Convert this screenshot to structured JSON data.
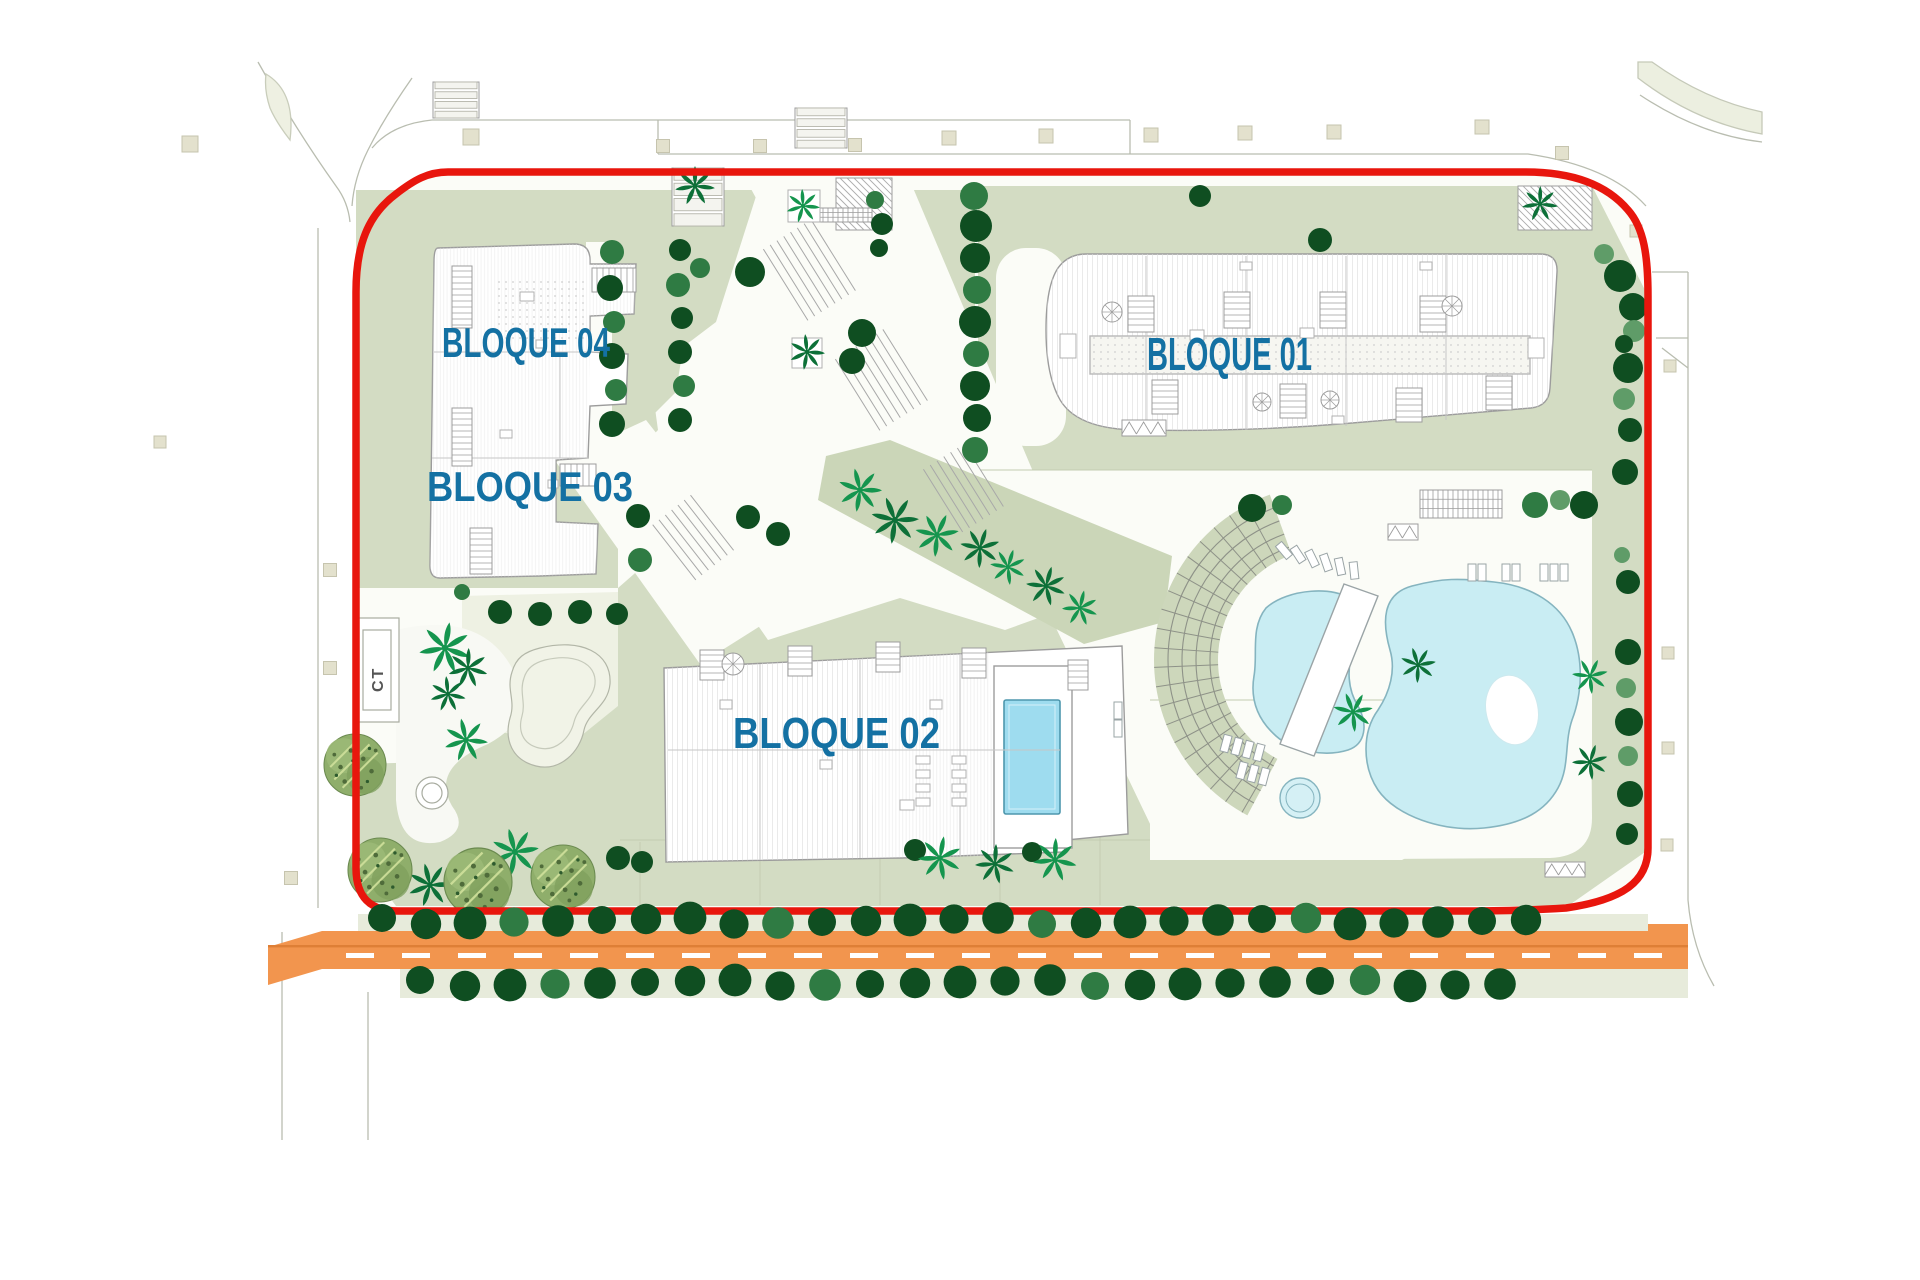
{
  "title": "Residential complex site plan",
  "labels": {
    "blocks": [
      {
        "id": "bloque-04",
        "text": "BLOQUE 04",
        "x": 442,
        "baseline": 357,
        "font": 42,
        "length": 168
      },
      {
        "id": "bloque-03",
        "text": "BLOQUE 03",
        "x": 427,
        "baseline": 501,
        "font": 42,
        "length": 206
      },
      {
        "id": "bloque-02",
        "text": "BLOQUE 02",
        "x": 733,
        "baseline": 748,
        "font": 44,
        "length": 207
      },
      {
        "id": "bloque-01",
        "text": "BLOQUE 01",
        "x": 1147,
        "baseline": 370,
        "font": 46,
        "length": 165
      }
    ],
    "ct": {
      "text": "CT"
    }
  },
  "palette": {
    "boundary_red": "#e8160d",
    "label_blue": "#1471a3",
    "sage": "#d3dcc3",
    "sage_light": "#e7ebdb",
    "cream": "#eef1e3",
    "site_white": "#fbfcf7",
    "road_orange": "#f2954e",
    "road_line": "#de7f36",
    "pool_fill": "#c9edf3",
    "pool_stroke": "#85b4bf",
    "pool_deep": "#9edcef",
    "tree_greens": [
      "#0f4e21",
      "#2f7b43",
      "#5f9c68"
    ],
    "palm_greens": [
      "#15954e",
      "#0d7038",
      "#0a5e2f"
    ],
    "outline_gray": "#9c9c9c"
  },
  "features": {
    "tree_circles": [
      [
        612,
        252,
        12,
        1
      ],
      [
        610,
        288,
        13,
        0
      ],
      [
        614,
        322,
        11,
        1
      ],
      [
        612,
        356,
        13,
        0
      ],
      [
        616,
        390,
        11,
        1
      ],
      [
        612,
        424,
        13,
        0
      ],
      [
        638,
        516,
        12,
        0
      ],
      [
        640,
        560,
        12,
        1
      ],
      [
        680,
        250,
        11,
        0
      ],
      [
        678,
        285,
        12,
        1
      ],
      [
        682,
        318,
        11,
        0
      ],
      [
        680,
        352,
        12,
        0
      ],
      [
        684,
        386,
        11,
        1
      ],
      [
        680,
        420,
        12,
        0
      ],
      [
        974,
        196,
        14,
        1
      ],
      [
        976,
        226,
        16,
        0
      ],
      [
        975,
        258,
        15,
        0
      ],
      [
        977,
        290,
        14,
        1
      ],
      [
        975,
        322,
        16,
        0
      ],
      [
        976,
        354,
        13,
        1
      ],
      [
        975,
        386,
        15,
        0
      ],
      [
        977,
        418,
        14,
        0
      ],
      [
        975,
        450,
        13,
        1
      ],
      [
        1604,
        254,
        10,
        2
      ],
      [
        1620,
        276,
        16,
        0
      ],
      [
        1633,
        307,
        14,
        0
      ],
      [
        1634,
        331,
        11,
        2
      ],
      [
        1624,
        344,
        9,
        0
      ],
      [
        1628,
        368,
        15,
        0
      ],
      [
        1624,
        399,
        11,
        2
      ],
      [
        1630,
        430,
        12,
        0
      ],
      [
        1625,
        472,
        13,
        0
      ],
      [
        1622,
        555,
        8,
        2
      ],
      [
        1628,
        582,
        12,
        0
      ],
      [
        1628,
        652,
        13,
        0
      ],
      [
        1626,
        688,
        10,
        2
      ],
      [
        1629,
        722,
        14,
        0
      ],
      [
        1628,
        756,
        10,
        2
      ],
      [
        1630,
        794,
        13,
        0
      ],
      [
        1627,
        834,
        11,
        0
      ],
      [
        750,
        272,
        15,
        0
      ],
      [
        700,
        268,
        10,
        1
      ],
      [
        862,
        333,
        14,
        0
      ],
      [
        852,
        361,
        13,
        0
      ],
      [
        748,
        517,
        12,
        0
      ],
      [
        778,
        534,
        12,
        0
      ],
      [
        875,
        200,
        9,
        1
      ],
      [
        882,
        224,
        11,
        0
      ],
      [
        879,
        248,
        9,
        0
      ],
      [
        1252,
        508,
        14,
        0
      ],
      [
        1282,
        505,
        10,
        1
      ],
      [
        1535,
        505,
        13,
        1
      ],
      [
        1560,
        500,
        10,
        2
      ],
      [
        1584,
        505,
        14,
        0
      ],
      [
        1200,
        196,
        11,
        0
      ],
      [
        1320,
        240,
        12,
        0
      ],
      [
        618,
        858,
        12,
        0
      ],
      [
        642,
        862,
        11,
        0
      ],
      [
        915,
        850,
        11,
        0
      ],
      [
        1032,
        852,
        10,
        0
      ],
      [
        500,
        612,
        12,
        0
      ],
      [
        540,
        614,
        12,
        0
      ],
      [
        580,
        612,
        12,
        0
      ],
      [
        617,
        614,
        11,
        0
      ],
      [
        462,
        592,
        8,
        1
      ]
    ],
    "road_tree_rows": [
      {
        "y": 921,
        "x0": 382,
        "step": 44,
        "n": 27
      },
      {
        "y": 983,
        "x0": 420,
        "step": 45,
        "n": 25
      }
    ],
    "palms": [
      [
        695,
        186,
        20,
        1
      ],
      [
        803,
        206,
        17,
        0
      ],
      [
        807,
        352,
        18,
        1
      ],
      [
        860,
        490,
        22,
        0
      ],
      [
        895,
        520,
        24,
        1
      ],
      [
        937,
        535,
        22,
        0
      ],
      [
        980,
        548,
        20,
        1
      ],
      [
        1008,
        567,
        18,
        0
      ],
      [
        1046,
        586,
        20,
        1
      ],
      [
        1080,
        608,
        18,
        0
      ],
      [
        445,
        648,
        26,
        0
      ],
      [
        468,
        668,
        20,
        1
      ],
      [
        448,
        694,
        18,
        1
      ],
      [
        466,
        740,
        22,
        0
      ],
      [
        430,
        885,
        22,
        1
      ],
      [
        515,
        852,
        24,
        0
      ],
      [
        1418,
        665,
        18,
        1
      ],
      [
        1353,
        712,
        20,
        0
      ],
      [
        1590,
        676,
        18,
        0
      ],
      [
        1590,
        762,
        18,
        1
      ],
      [
        940,
        858,
        22,
        0
      ],
      [
        995,
        864,
        20,
        1
      ],
      [
        1055,
        860,
        22,
        0
      ],
      [
        1540,
        204,
        18,
        1
      ]
    ],
    "olive_trees": [
      [
        355,
        765,
        31
      ],
      [
        380,
        870,
        32
      ],
      [
        478,
        882,
        34
      ],
      [
        563,
        877,
        32
      ]
    ],
    "beige_squares": [
      [
        190,
        144,
        16
      ],
      [
        471,
        137,
        16
      ],
      [
        663,
        146,
        13
      ],
      [
        760,
        146,
        13
      ],
      [
        855,
        145,
        13
      ],
      [
        949,
        138,
        14
      ],
      [
        1046,
        136,
        14
      ],
      [
        1151,
        135,
        14
      ],
      [
        1245,
        133,
        14
      ],
      [
        1334,
        132,
        14
      ],
      [
        1482,
        127,
        14
      ],
      [
        1562,
        153,
        13
      ],
      [
        1636,
        231,
        12
      ],
      [
        1670,
        366,
        12
      ],
      [
        1668,
        653,
        12
      ],
      [
        1668,
        748,
        12
      ],
      [
        1667,
        845,
        12
      ],
      [
        330,
        570,
        13
      ],
      [
        330,
        668,
        13
      ],
      [
        291,
        878,
        13
      ],
      [
        160,
        442,
        12
      ]
    ],
    "loungers": [
      [
        1280,
        542,
        -40
      ],
      [
        1294,
        546,
        -33
      ],
      [
        1308,
        550,
        -26
      ],
      [
        1322,
        554,
        -19
      ],
      [
        1336,
        558,
        -12
      ],
      [
        1350,
        562,
        -6
      ],
      [
        1468,
        564,
        0
      ],
      [
        1478,
        564,
        0
      ],
      [
        1502,
        564,
        0
      ],
      [
        1512,
        564,
        0
      ],
      [
        1540,
        564,
        0
      ],
      [
        1550,
        564,
        0
      ],
      [
        1560,
        564,
        0
      ],
      [
        1222,
        735,
        15
      ],
      [
        1233,
        738,
        15
      ],
      [
        1244,
        741,
        15
      ],
      [
        1255,
        744,
        15
      ],
      [
        1238,
        762,
        15
      ],
      [
        1249,
        765,
        15
      ],
      [
        1260,
        768,
        15
      ],
      [
        1114,
        702,
        0
      ],
      [
        1114,
        720,
        0
      ]
    ],
    "pergolas": [
      {
        "x": 1420,
        "y": 490,
        "w": 82,
        "h": 28,
        "type": "rail"
      },
      {
        "x": 1388,
        "y": 524,
        "w": 30,
        "h": 16,
        "type": "v"
      },
      {
        "x": 1122,
        "y": 420,
        "w": 44,
        "h": 16,
        "type": "v"
      },
      {
        "x": 1545,
        "y": 862,
        "w": 40,
        "h": 15,
        "type": "v"
      },
      {
        "x": 1518,
        "y": 186,
        "w": 74,
        "h": 44,
        "type": "d"
      },
      {
        "x": 836,
        "y": 178,
        "w": 56,
        "h": 52,
        "type": "d"
      },
      {
        "x": 672,
        "y": 168,
        "w": 52,
        "h": 58,
        "type": "h2"
      },
      {
        "x": 433,
        "y": 82,
        "w": 46,
        "h": 36,
        "type": "h2"
      },
      {
        "x": 795,
        "y": 108,
        "w": 52,
        "h": 40,
        "type": "h2"
      },
      {
        "x": 820,
        "y": 208,
        "w": 52,
        "h": 14,
        "type": "rail"
      }
    ],
    "step_bands": [
      {
        "x": 806,
        "y": 272,
        "len": 84,
        "n": 8,
        "rot": 58
      },
      {
        "x": 878,
        "y": 382,
        "len": 84,
        "n": 8,
        "rot": 58
      },
      {
        "x": 960,
        "y": 490,
        "len": 74,
        "n": 7,
        "rot": 58
      },
      {
        "x": 690,
        "y": 540,
        "len": 70,
        "n": 7,
        "rot": 52
      }
    ],
    "stairs": [
      [
        452,
        266,
        20,
        62,
        "v"
      ],
      [
        592,
        268,
        44,
        24,
        "h"
      ],
      [
        452,
        408,
        20,
        58,
        "v"
      ],
      [
        560,
        464,
        36,
        22,
        "h"
      ],
      [
        470,
        528,
        22,
        46,
        "v"
      ],
      [
        1128,
        296,
        26,
        36,
        "v"
      ],
      [
        1224,
        292,
        26,
        36,
        "v"
      ],
      [
        1320,
        292,
        26,
        36,
        "v"
      ],
      [
        1420,
        296,
        26,
        36,
        "v"
      ],
      [
        1152,
        380,
        26,
        34,
        "v"
      ],
      [
        1280,
        384,
        26,
        34,
        "v"
      ],
      [
        1396,
        388,
        26,
        34,
        "v"
      ],
      [
        1486,
        376,
        26,
        34,
        "v"
      ],
      [
        700,
        650,
        24,
        30,
        "v"
      ],
      [
        788,
        646,
        24,
        30,
        "v"
      ],
      [
        876,
        642,
        24,
        30,
        "v"
      ],
      [
        962,
        648,
        24,
        30,
        "v"
      ],
      [
        1068,
        660,
        20,
        30,
        "v"
      ]
    ],
    "spirals": [
      [
        1112,
        312,
        10
      ],
      [
        1452,
        306,
        10
      ],
      [
        1262,
        402,
        9
      ],
      [
        1330,
        400,
        9
      ],
      [
        733,
        664,
        11
      ]
    ],
    "roof_boxes": [
      [
        1060,
        334,
        16,
        24
      ],
      [
        1190,
        330,
        14,
        10
      ],
      [
        1300,
        328,
        14,
        10
      ],
      [
        1528,
        338,
        16,
        20
      ],
      [
        1240,
        262,
        12,
        8
      ],
      [
        1420,
        262,
        12,
        8
      ],
      [
        1332,
        416,
        12,
        8
      ],
      [
        520,
        292,
        14,
        9
      ],
      [
        536,
        340,
        10,
        8
      ],
      [
        500,
        430,
        12,
        8
      ],
      [
        548,
        480,
        10,
        8
      ],
      [
        720,
        700,
        12,
        9
      ],
      [
        820,
        760,
        12,
        9
      ],
      [
        930,
        700,
        12,
        9
      ],
      [
        900,
        800,
        14,
        10
      ],
      [
        916,
        756,
        14,
        8
      ],
      [
        916,
        770,
        14,
        8
      ],
      [
        916,
        784,
        14,
        8
      ],
      [
        916,
        798,
        14,
        8
      ],
      [
        952,
        756,
        14,
        8
      ],
      [
        952,
        770,
        14,
        8
      ],
      [
        952,
        784,
        14,
        8
      ],
      [
        952,
        798,
        14,
        8
      ],
      [
        788,
        190,
        32,
        32
      ],
      [
        792,
        338,
        30,
        30
      ]
    ],
    "amphitheater": {
      "cx": 1330,
      "cy": 660,
      "r_inner": 112,
      "r_outer": 176,
      "angle_start": 118,
      "angle_end": 250,
      "arc_radii": [
        120,
        134,
        148,
        162
      ],
      "radial_step": 6.4
    },
    "road": {
      "dash_y": 953,
      "dash_h": 5,
      "dash_w": 28,
      "dash_gap": 28,
      "dash_x0": 346,
      "dash_x1": 1672
    }
  }
}
